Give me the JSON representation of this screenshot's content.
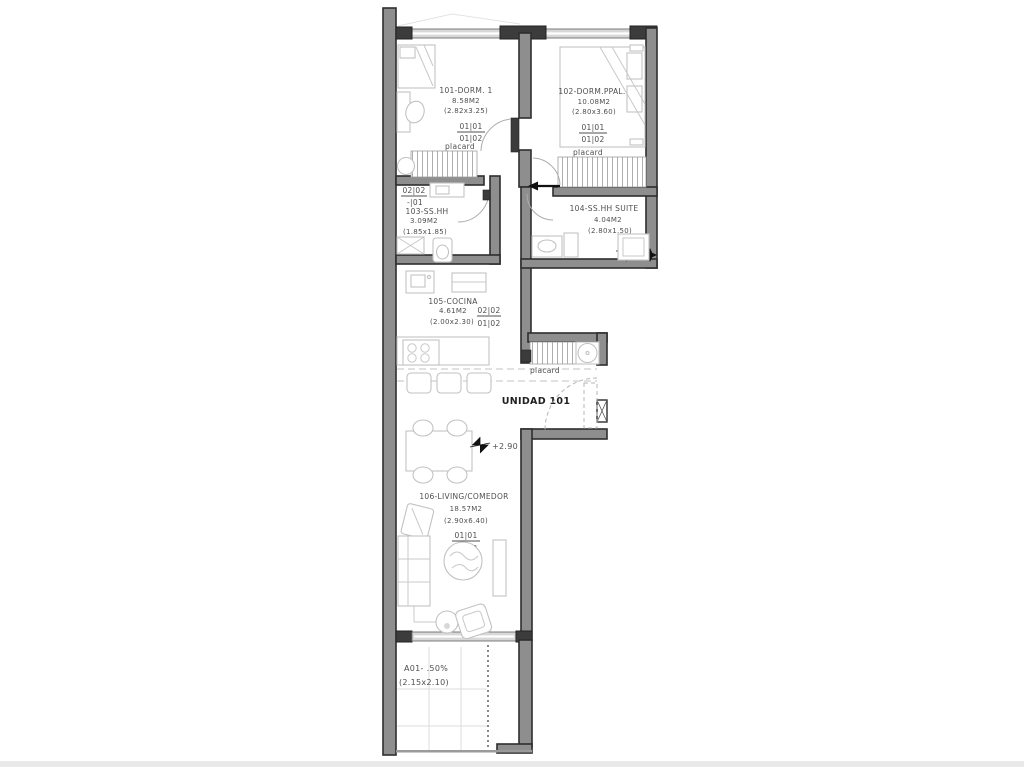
{
  "title": {
    "unit": "UNIDAD 101",
    "level": "+2.90"
  },
  "rooms": {
    "r101": {
      "name": "101-DORM. 1",
      "area": "8.58M2",
      "dims": "(2.82x3.25)",
      "code_top": "01|01",
      "code_bot": "01|02",
      "placard": "placard"
    },
    "r102": {
      "name": "102-DORM.PPAL.",
      "area": "10.08M2",
      "dims": "(2.80x3.60)",
      "code_top": "01|01",
      "code_bot": "01|02",
      "placard": "placard"
    },
    "r103": {
      "name": "103-SS.HH",
      "area": "3.09M2",
      "dims": "(1.85x1.85)",
      "code_top": "02|02",
      "code_bot": "-|01"
    },
    "r104": {
      "name": "104-SS.HH  SUITE",
      "area": "4.04M2",
      "dims": "(2.80x1.50)",
      "code_top": "02|02",
      "code_bot": "-|01"
    },
    "r105": {
      "name": "105-COCINA",
      "area": "4.61M2",
      "dims": "(2.00x2.30)",
      "code_top": "02|02",
      "code_bot": "01|02"
    },
    "r106": {
      "name": "106-LIVING/COMEDOR",
      "area": "18.57M2",
      "dims": "(2.90x6.40)",
      "code_top": "01|01",
      "code_bot": "01|02"
    },
    "balcony": {
      "name": "A01- .50%",
      "dims": "(2.15x2.10)"
    }
  },
  "entry": {
    "placard": "placard"
  },
  "colors": {
    "wall": "#3c3c3c",
    "wall_fill": "#8e8e8e",
    "furniture": "#c2c2c2",
    "text": "#4f4f4f",
    "background": "#ffffff"
  }
}
